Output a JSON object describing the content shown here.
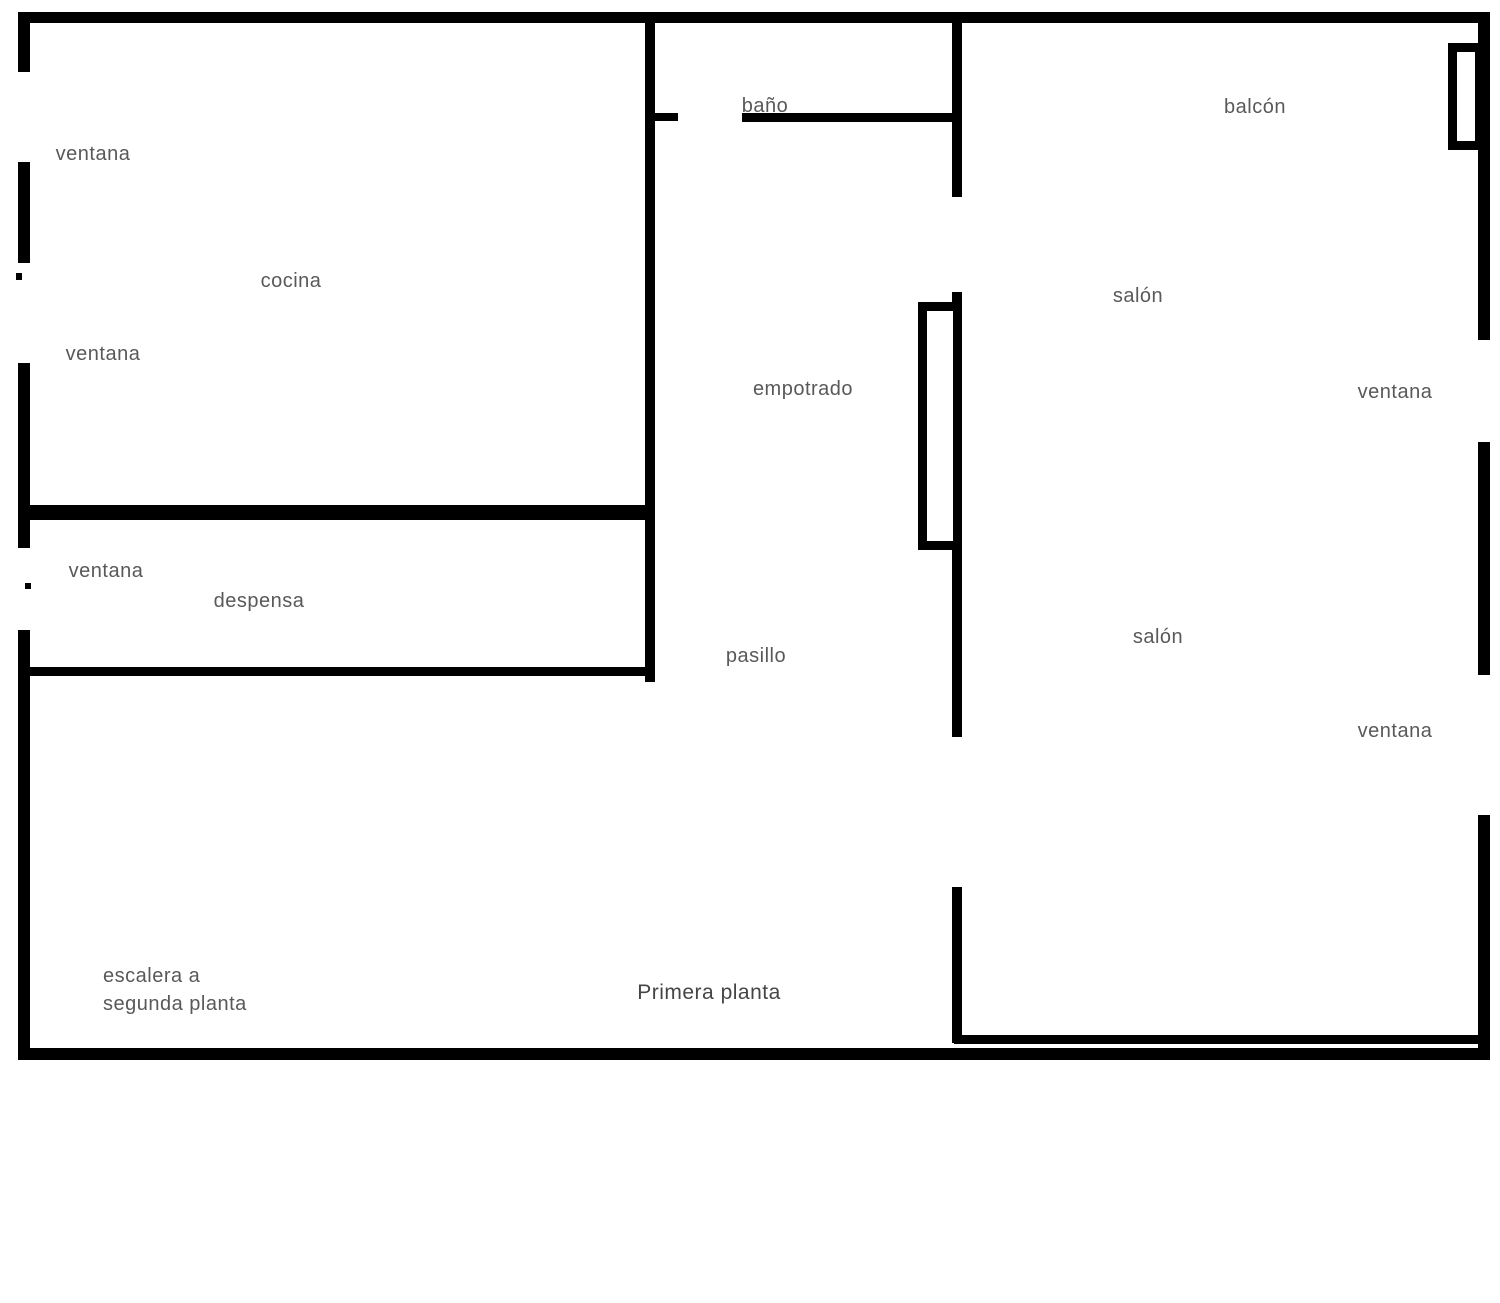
{
  "floorplan": {
    "name": "Primera planta - plano",
    "colors": {
      "background": "#ffffff",
      "wall": "#000000",
      "label": "#595959",
      "label_dark": "#454545"
    },
    "labels": [
      {
        "name": "label-ventana-left-1",
        "text": "ventana",
        "cx": 93,
        "cy": 154
      },
      {
        "name": "label-ventana-left-2",
        "text": "ventana",
        "cx": 103,
        "cy": 354
      },
      {
        "name": "label-ventana-left-3",
        "text": "ventana",
        "cx": 106,
        "cy": 571
      },
      {
        "name": "label-cocina",
        "text": "cocina",
        "cx": 291,
        "cy": 281
      },
      {
        "name": "label-despensa",
        "text": "despensa",
        "cx": 259,
        "cy": 601
      },
      {
        "name": "label-bano",
        "text": "baño",
        "cx": 765,
        "cy": 106
      },
      {
        "name": "label-empotrado",
        "text": "empotrado",
        "cx": 803,
        "cy": 389
      },
      {
        "name": "label-pasillo",
        "text": "pasillo",
        "cx": 756,
        "cy": 656
      },
      {
        "name": "label-salon-1",
        "text": "salón",
        "cx": 1138,
        "cy": 296
      },
      {
        "name": "label-salon-2",
        "text": "salón",
        "cx": 1158,
        "cy": 637
      },
      {
        "name": "label-ventana-right-1",
        "text": "ventana",
        "cx": 1395,
        "cy": 392
      },
      {
        "name": "label-ventana-right-2",
        "text": "ventana",
        "cx": 1395,
        "cy": 731
      },
      {
        "name": "label-balcon",
        "text": "balcón",
        "cx": 1255,
        "cy": 107
      },
      {
        "name": "label-escalera",
        "text": "escalera a\nsegunda planta",
        "x": 103,
        "y": 962
      },
      {
        "name": "label-primera-planta",
        "text": "Primera planta",
        "cx": 709,
        "cy": 993,
        "dark": true
      }
    ],
    "walls": [
      {
        "name": "wall-outer-top",
        "x": 18,
        "y": 12,
        "w": 1472,
        "h": 11
      },
      {
        "name": "wall-outer-left-a",
        "x": 18,
        "y": 12,
        "w": 12,
        "h": 60
      },
      {
        "name": "wall-outer-left-b",
        "x": 18,
        "y": 162,
        "w": 12,
        "h": 101
      },
      {
        "name": "wall-outer-left-c",
        "x": 18,
        "y": 363,
        "w": 12,
        "h": 185
      },
      {
        "name": "wall-outer-left-d",
        "x": 18,
        "y": 630,
        "w": 12,
        "h": 428
      },
      {
        "name": "wall-outer-bottom",
        "x": 18,
        "y": 1048,
        "w": 1472,
        "h": 12
      },
      {
        "name": "wall-outer-right-a",
        "x": 1478,
        "y": 12,
        "w": 12,
        "h": 328
      },
      {
        "name": "wall-outer-right-b",
        "x": 1478,
        "y": 442,
        "w": 12,
        "h": 233
      },
      {
        "name": "wall-outer-right-c",
        "x": 1478,
        "y": 815,
        "w": 12,
        "h": 243
      },
      {
        "name": "wall-hall-left",
        "x": 645,
        "y": 12,
        "w": 10,
        "h": 670
      },
      {
        "name": "wall-kitchen-bottom",
        "x": 18,
        "y": 505,
        "w": 637,
        "h": 15
      },
      {
        "name": "wall-pantry-bottom",
        "x": 18,
        "y": 667,
        "w": 637,
        "h": 9
      },
      {
        "name": "wall-bath-bottom-stub",
        "x": 645,
        "y": 113,
        "w": 33,
        "h": 8
      },
      {
        "name": "wall-bath-bottom",
        "x": 742,
        "y": 113,
        "w": 216,
        "h": 9
      },
      {
        "name": "wall-hall-right-top",
        "x": 952,
        "y": 12,
        "w": 10,
        "h": 185
      },
      {
        "name": "wall-hall-right-mid",
        "x": 952,
        "y": 292,
        "w": 10,
        "h": 445
      },
      {
        "name": "wall-hall-right-bottom",
        "x": 952,
        "y": 887,
        "w": 10,
        "h": 156
      },
      {
        "name": "wall-salon-bottom-inner",
        "x": 954,
        "y": 1035,
        "w": 526,
        "h": 9
      }
    ],
    "fixtures": [
      {
        "name": "empotrado-closet",
        "x": 918,
        "y": 302,
        "w": 44,
        "h": 248,
        "stroke": 9
      },
      {
        "name": "balcon-window-fixture",
        "x": 1448,
        "y": 43,
        "w": 36,
        "h": 107,
        "stroke": 9
      }
    ],
    "marks": [
      {
        "name": "wall-mark-1",
        "x": 16,
        "y": 273,
        "w": 6,
        "h": 7
      },
      {
        "name": "wall-mark-2",
        "x": 25,
        "y": 583,
        "w": 6,
        "h": 6
      }
    ]
  }
}
